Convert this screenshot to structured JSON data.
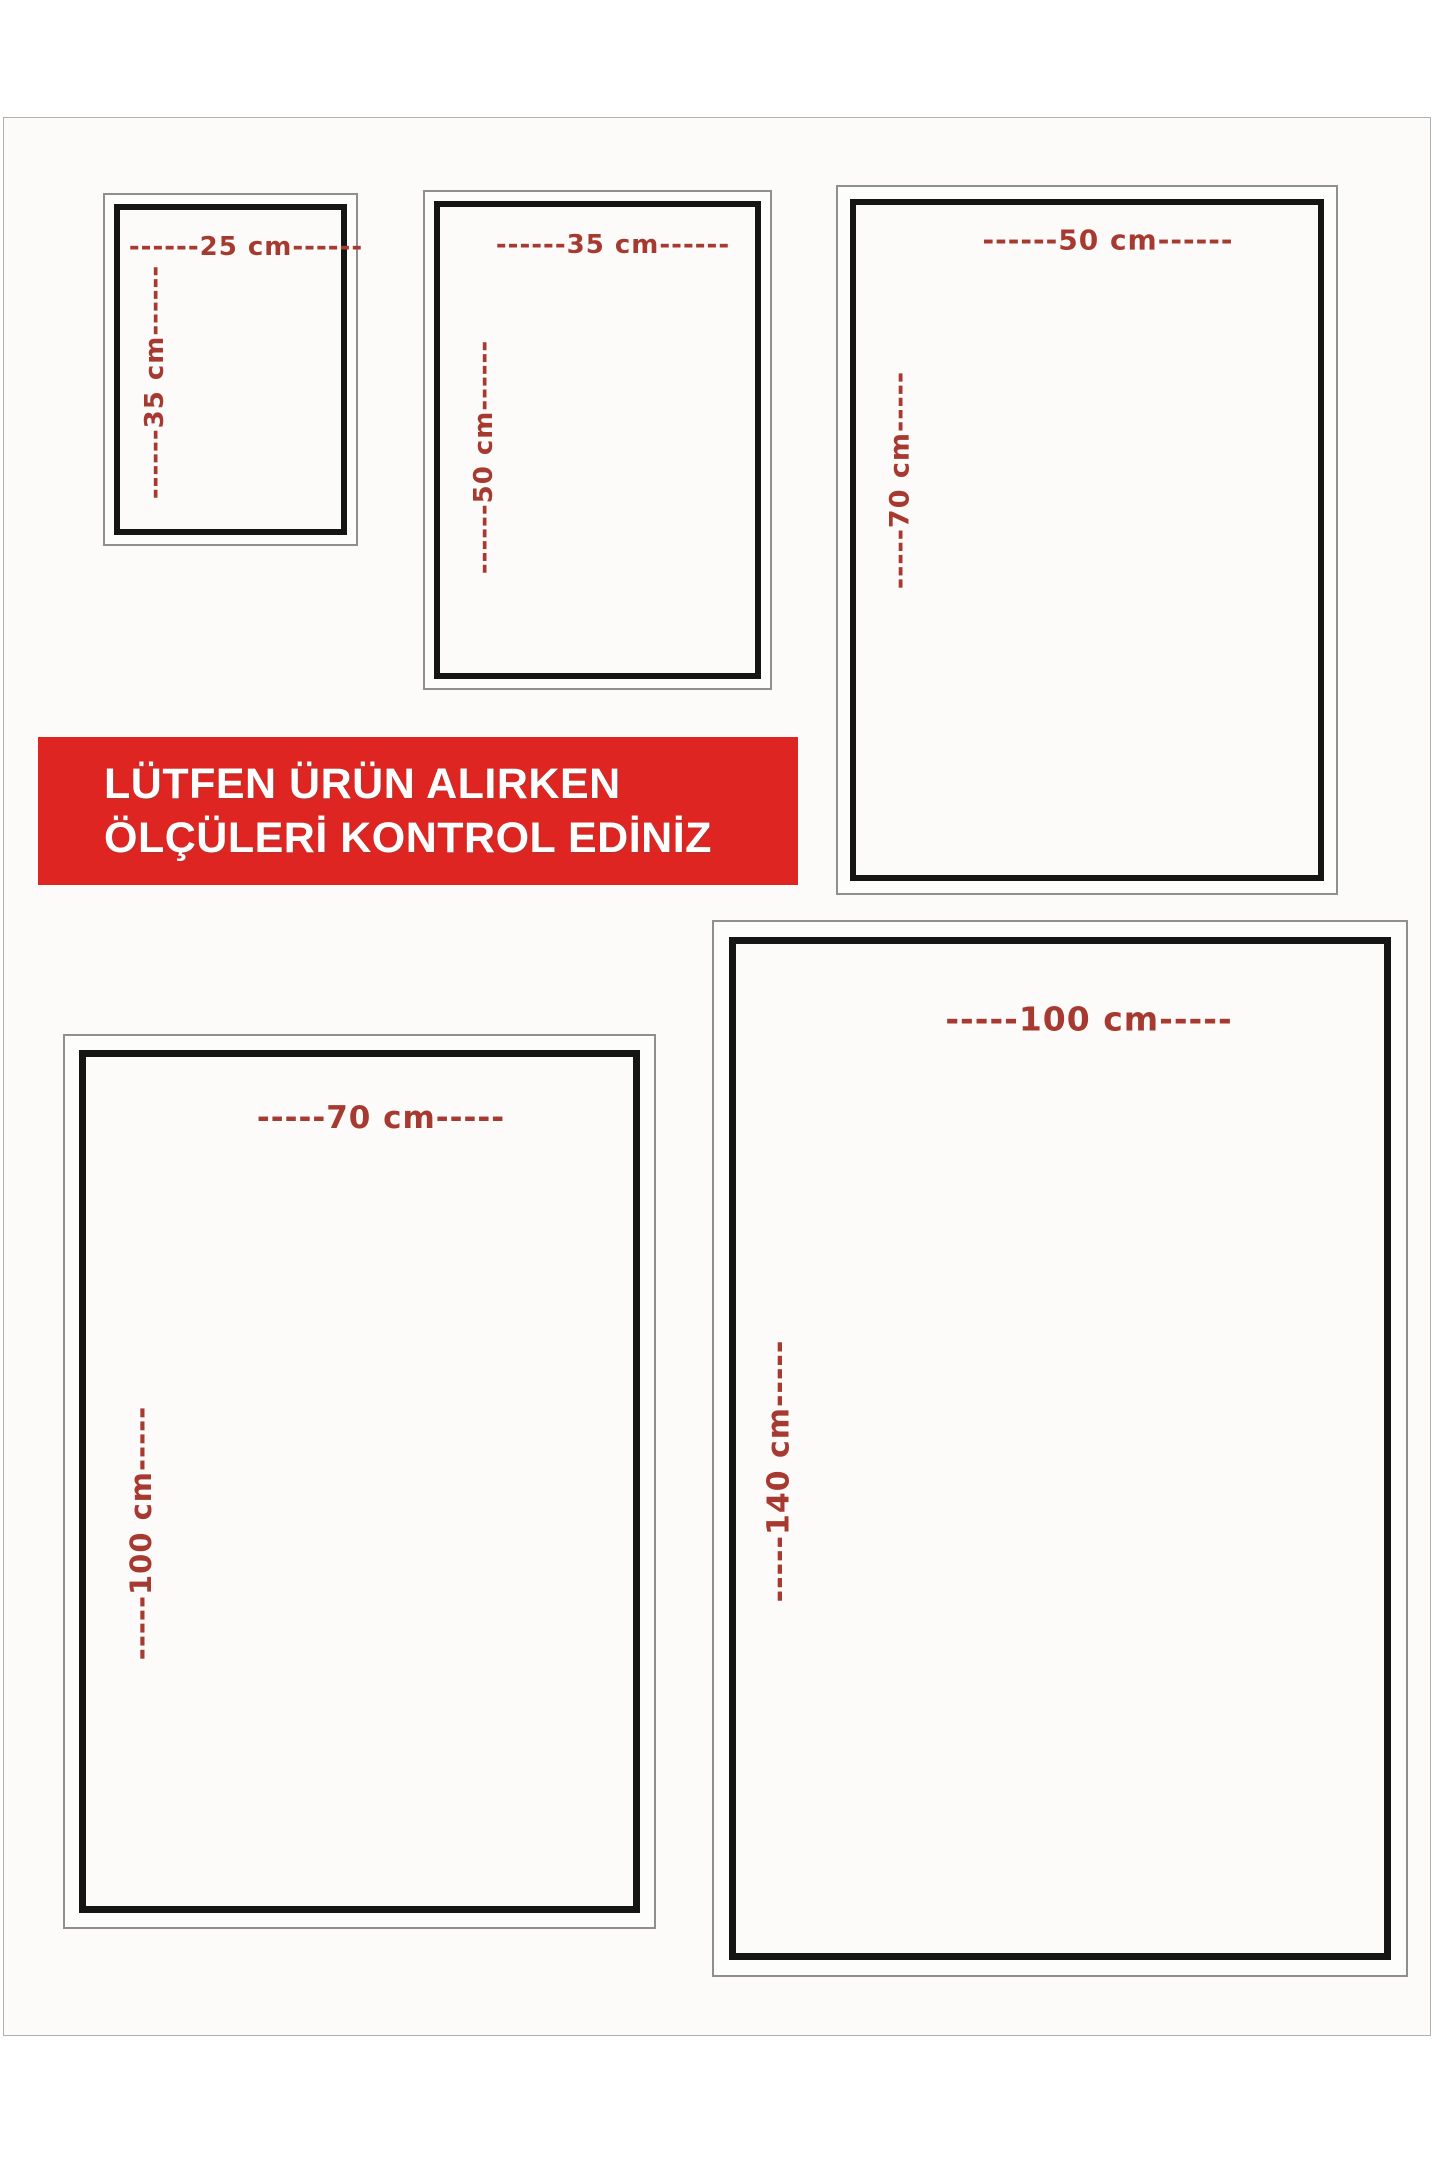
{
  "notice_banner": {
    "line1": "LÜTFEN ÜRÜN ALIRKEN",
    "line2": "ÖLÇÜLERİ KONTROL EDİNİZ",
    "background_color": "#de2521",
    "text_color": "#ffffff"
  },
  "sizes": [
    {
      "name": "25x35 cm",
      "width_cm": 25,
      "height_cm": 35,
      "width_label": "------25 cm------",
      "height_label": "------35 cm------"
    },
    {
      "name": "35x50 cm",
      "width_cm": 35,
      "height_cm": 50,
      "width_label": "------35 cm------",
      "height_label": "------50 cm------"
    },
    {
      "name": "50x70 cm",
      "width_cm": 50,
      "height_cm": 70,
      "width_label": "------50 cm------",
      "height_label": "-----70 cm-----"
    },
    {
      "name": "70x100 cm",
      "width_cm": 70,
      "height_cm": 100,
      "width_label": "-----70 cm-----",
      "height_label": "-----100 cm-----"
    },
    {
      "name": "100x140 cm",
      "width_cm": 100,
      "height_cm": 140,
      "width_label": "-----100 cm-----",
      "height_label": "-----140 cm-----"
    }
  ],
  "colors": {
    "dimension_label_red": "#a63a30",
    "frame_black": "#151515",
    "frame_gray": "#8f8f8f",
    "page_background": "#fcfbfa"
  }
}
